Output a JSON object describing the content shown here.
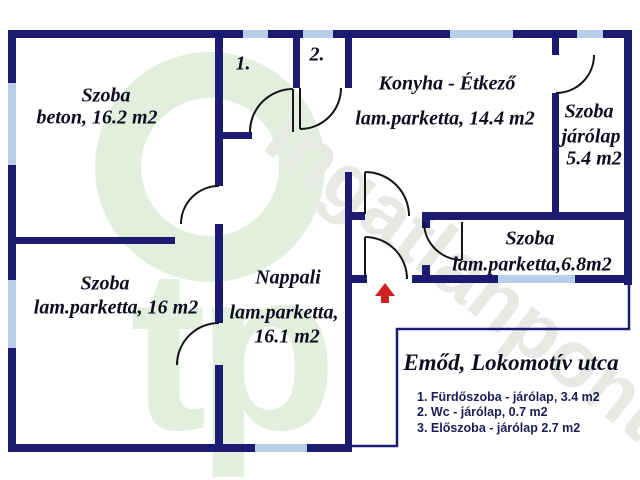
{
  "colors": {
    "wall": "#1b1b72",
    "window": "#b7cfe8",
    "door": "#141414",
    "arrow": "#d01f1f",
    "label": "#0d0d22",
    "legend": "#1d1d55",
    "wm-green": "#e2efdd",
    "wm-gray": "#e6e9e4"
  },
  "rooms": [
    {
      "id": "szoba-beton",
      "lines": [
        "Szoba",
        "beton, 16.2 m2"
      ]
    },
    {
      "id": "konyha-etkezo",
      "lines": [
        "Konyha - Étkező",
        "lam.parketta, 14.4 m2"
      ]
    },
    {
      "id": "szoba-jarolap-54",
      "lines": [
        "Szoba",
        "járólap",
        "5.4 m2"
      ]
    },
    {
      "id": "szoba-68",
      "lines": [
        "Szoba",
        "lam.parketta,6.8m2"
      ]
    },
    {
      "id": "nappali",
      "lines": [
        "Nappali",
        "lam.parketta,",
        "16.1 m2"
      ]
    },
    {
      "id": "szoba-16",
      "lines": [
        "Szoba",
        "lam.parketta, 16 m2"
      ]
    },
    {
      "id": "room-1-number",
      "lines": [
        "1."
      ]
    },
    {
      "id": "room-2-number",
      "lines": [
        "2."
      ]
    }
  ],
  "legend": {
    "title": "Emőd, Lokomotív utca",
    "items": [
      "1. Fürdőszoba - járólap, 3.4 m2",
      "2. Wc - járólap, 0.7 m2",
      "3. Előszoba - járólap 2.7 m2"
    ]
  },
  "watermark": {
    "circle_text": "tp",
    "diagonal_text": "Ingatlanpont"
  }
}
